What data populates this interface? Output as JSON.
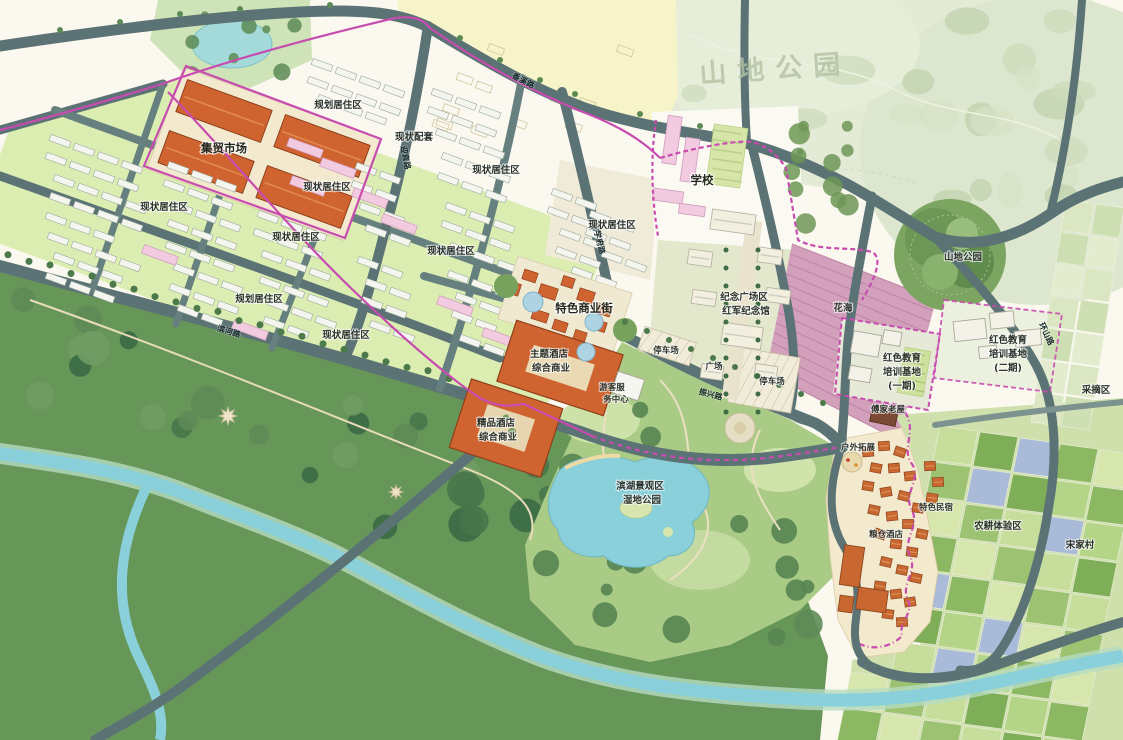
{
  "map_type": "urban-master-plan-rendering",
  "palette": {
    "road": "#5b7375",
    "minor_road": "#66807f",
    "residential_bg": "#dcedb2",
    "building_white": "#f4f5ee",
    "building_pink": "#f3cbe1",
    "building_orange": "#cf6430",
    "parking_cream": "#f2e9cf",
    "yellow_zone": "#f6f4c8",
    "forest": "#679659",
    "park": "#a9cb86",
    "water": "#8ad0da",
    "flower_field": "#d3a0bb",
    "boundary_magenta": "#c84cb0",
    "village_roof": "#c8672f"
  },
  "labels": [
    {
      "text": "集贸市场",
      "x": 224,
      "y": 152,
      "cls": "zone-lg",
      "rot": 0
    },
    {
      "text": "规划居住区",
      "x": 338,
      "y": 108,
      "cls": "zone",
      "rot": 0
    },
    {
      "text": "现状配套",
      "x": 414,
      "y": 140,
      "cls": "zone",
      "rot": 0
    },
    {
      "text": "现状居住区",
      "x": 164,
      "y": 210,
      "cls": "zone",
      "rot": 0
    },
    {
      "text": "现状居住区",
      "x": 327,
      "y": 190,
      "cls": "zone",
      "rot": 0
    },
    {
      "text": "现状居住区",
      "x": 496,
      "y": 173,
      "cls": "zone",
      "rot": 0
    },
    {
      "text": "现状居住区",
      "x": 296,
      "y": 240,
      "cls": "zone",
      "rot": 0
    },
    {
      "text": "现状居住区",
      "x": 451,
      "y": 254,
      "cls": "zone",
      "rot": 0
    },
    {
      "text": "规划居住区",
      "x": 259,
      "y": 302,
      "cls": "zone",
      "rot": 0
    },
    {
      "text": "现状居住区",
      "x": 346,
      "y": 338,
      "cls": "zone",
      "rot": 0
    },
    {
      "text": "现状居住区",
      "x": 612,
      "y": 228,
      "cls": "zone",
      "rot": 0
    },
    {
      "text": "特色商业街",
      "x": 584,
      "y": 312,
      "cls": "zone-lg",
      "rot": 0
    },
    {
      "text": "主题酒店",
      "x": 549,
      "y": 357,
      "cls": "zone",
      "rot": 0
    },
    {
      "text": "综合商业",
      "x": 551,
      "y": 371,
      "cls": "zone",
      "rot": 0
    },
    {
      "text": "精品酒店",
      "x": 496,
      "y": 426,
      "cls": "zone",
      "rot": 0
    },
    {
      "text": "综合商业",
      "x": 498,
      "y": 440,
      "cls": "zone",
      "rot": 0
    },
    {
      "text": "学校",
      "x": 702,
      "y": 184,
      "cls": "zone-lg",
      "rot": 0
    },
    {
      "text": "纪念广场区",
      "x": 744,
      "y": 300,
      "cls": "zone",
      "rot": 0
    },
    {
      "text": "红军纪念馆",
      "x": 746,
      "y": 314,
      "cls": "zone",
      "rot": 0
    },
    {
      "text": "停车场",
      "x": 666,
      "y": 353,
      "cls": "zone-sm",
      "rot": 0
    },
    {
      "text": "广场",
      "x": 714,
      "y": 369,
      "cls": "zone-sm",
      "rot": 0
    },
    {
      "text": "停车场",
      "x": 772,
      "y": 384,
      "cls": "zone-sm",
      "rot": 0
    },
    {
      "text": "游客服",
      "x": 612,
      "y": 390,
      "cls": "zone-sm",
      "rot": 0
    },
    {
      "text": "务中心",
      "x": 616,
      "y": 402,
      "cls": "zone-sm",
      "rot": 0
    },
    {
      "text": "花海",
      "x": 843,
      "y": 311,
      "cls": "zone",
      "rot": 0
    },
    {
      "text": "山地公园",
      "x": 963,
      "y": 260,
      "cls": "zone",
      "rot": 0
    },
    {
      "text": "山地公园",
      "x": 776,
      "y": 78,
      "cls": "watermark",
      "rot": -4
    },
    {
      "text": "红色教育",
      "x": 902,
      "y": 361,
      "cls": "zone",
      "rot": 0
    },
    {
      "text": "培训基地",
      "x": 902,
      "y": 375,
      "cls": "zone",
      "rot": 0
    },
    {
      "text": "(一期)",
      "x": 902,
      "y": 389,
      "cls": "zone",
      "rot": 0
    },
    {
      "text": "红色教育",
      "x": 1008,
      "y": 343,
      "cls": "zone",
      "rot": 0
    },
    {
      "text": "培训基地",
      "x": 1008,
      "y": 357,
      "cls": "zone",
      "rot": 0
    },
    {
      "text": "(二期)",
      "x": 1008,
      "y": 371,
      "cls": "zone",
      "rot": 0
    },
    {
      "text": "采摘区",
      "x": 1096,
      "y": 393,
      "cls": "zone",
      "rot": 0
    },
    {
      "text": "傅家老屋",
      "x": 888,
      "y": 412,
      "cls": "zone-sm",
      "rot": 0
    },
    {
      "text": "户外拓展",
      "x": 858,
      "y": 450,
      "cls": "zone-sm",
      "rot": 0
    },
    {
      "text": "特色民宿",
      "x": 936,
      "y": 510,
      "cls": "zone-sm",
      "rot": 0
    },
    {
      "text": "粮仓酒店",
      "x": 886,
      "y": 537,
      "cls": "zone-sm",
      "rot": 0
    },
    {
      "text": "农耕体验区",
      "x": 998,
      "y": 529,
      "cls": "zone",
      "rot": 0
    },
    {
      "text": "宋家村",
      "x": 1080,
      "y": 548,
      "cls": "zone",
      "rot": 0
    },
    {
      "text": "滨湖景观区",
      "x": 640,
      "y": 489,
      "cls": "zone",
      "rot": 0
    },
    {
      "text": "湿地公园",
      "x": 642,
      "y": 503,
      "cls": "zone",
      "rot": 0
    },
    {
      "text": "香溪路",
      "x": 522,
      "y": 83,
      "cls": "road",
      "rot": 27
    },
    {
      "text": "迎宾路",
      "x": 403,
      "y": 158,
      "cls": "road",
      "rot": 80
    },
    {
      "text": "学府路",
      "x": 597,
      "y": 243,
      "cls": "road",
      "rot": 77
    },
    {
      "text": "振兴路",
      "x": 710,
      "y": 397,
      "cls": "road",
      "rot": 15
    },
    {
      "text": "环山路",
      "x": 1044,
      "y": 335,
      "cls": "road",
      "rot": 65
    },
    {
      "text": "滨河路",
      "x": 228,
      "y": 334,
      "cls": "road",
      "rot": 17
    }
  ]
}
